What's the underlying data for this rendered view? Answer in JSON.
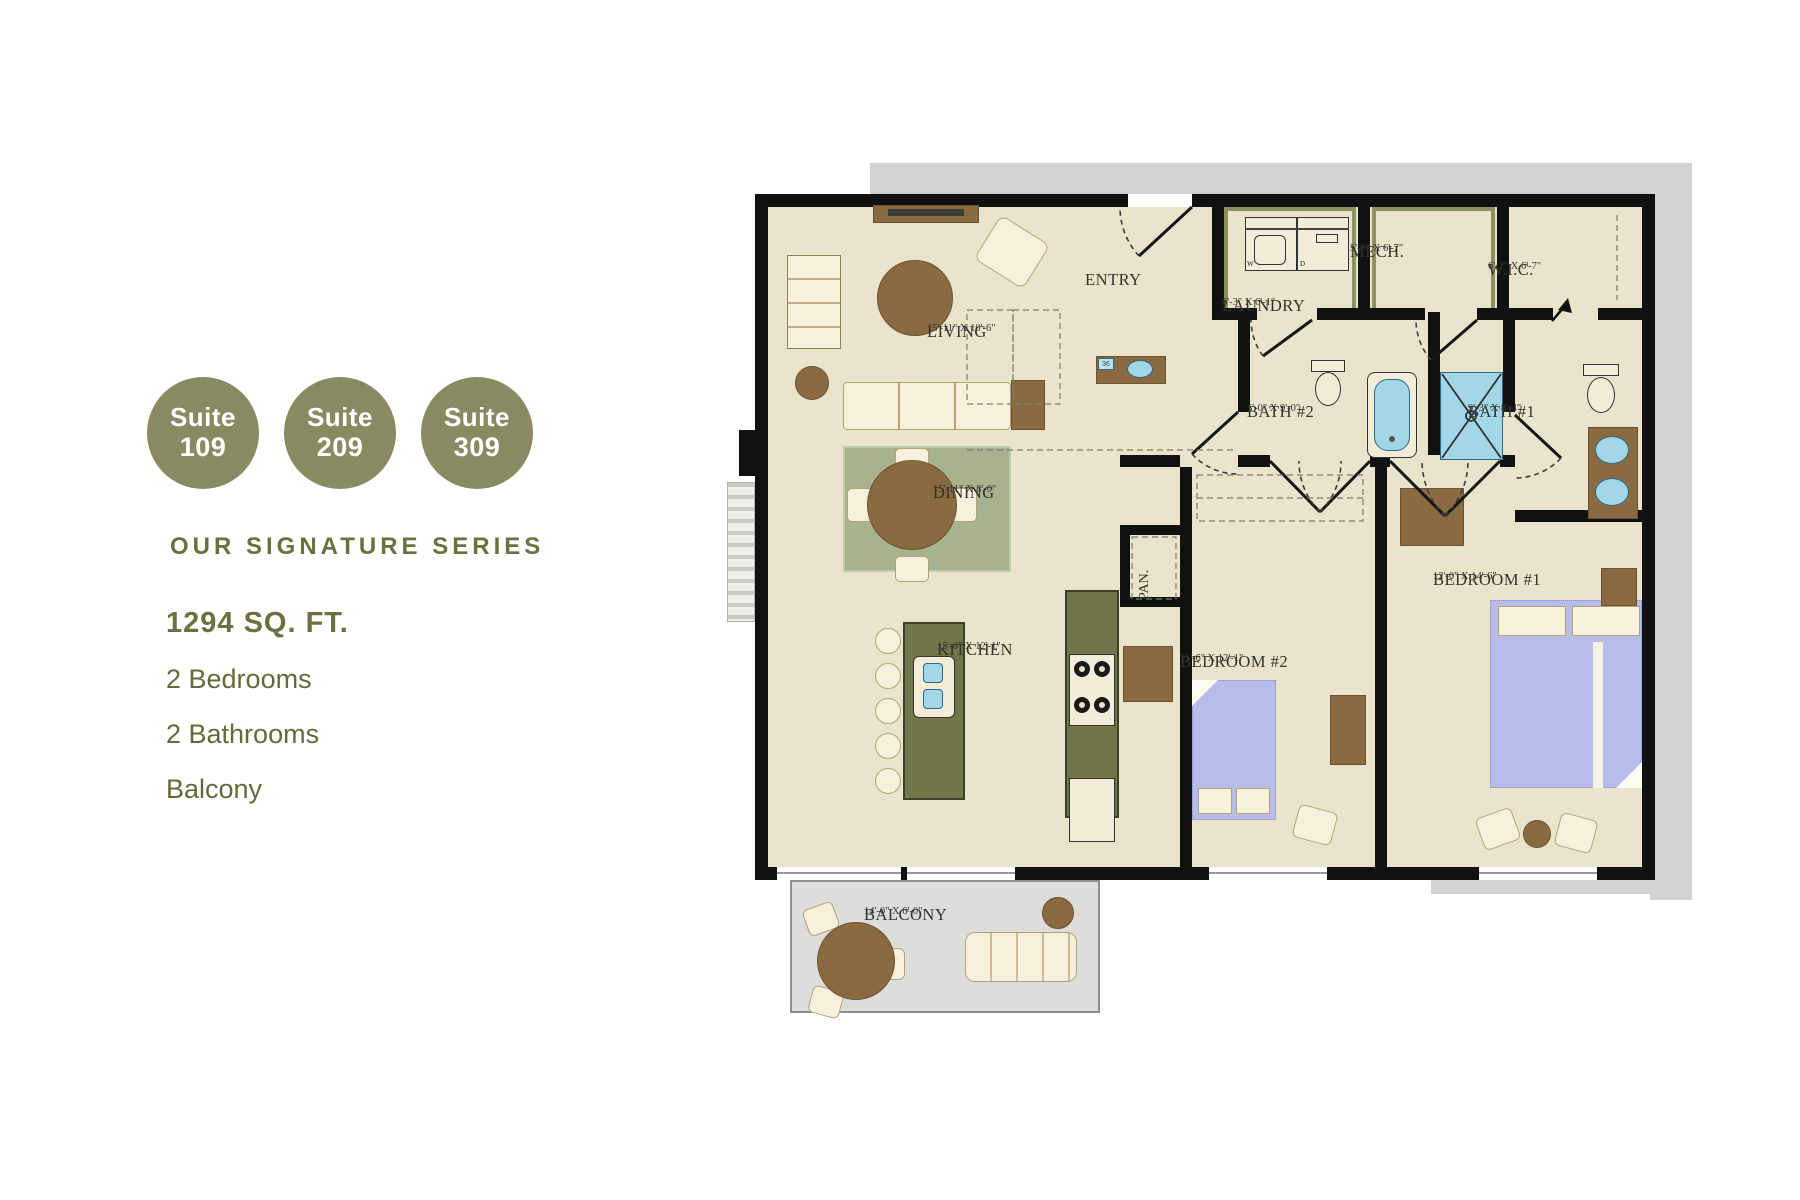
{
  "badges": [
    {
      "word": "Suite",
      "number": "109"
    },
    {
      "word": "Suite",
      "number": "209"
    },
    {
      "word": "Suite",
      "number": "309"
    }
  ],
  "info": {
    "series": "OUR SIGNATURE SERIES",
    "area": "1294 SQ. FT.",
    "features": [
      "2 Bedrooms",
      "2 Bathrooms",
      "Balcony"
    ]
  },
  "rooms": {
    "entry": {
      "label": "ENTRY",
      "dims": ""
    },
    "laundry": {
      "label": "LAUNDRY",
      "dims": "6'-3\" X 6'-1\""
    },
    "mech": {
      "label": "MECH.",
      "dims": "5'-9\" X 6'-7\""
    },
    "wic": {
      "label": "W.I.C.",
      "dims": "6'-2\" X 6'-7\""
    },
    "bath2": {
      "label": "BATH #2",
      "dims": "5'-0\" X 9'-0\""
    },
    "bath1": {
      "label": "BATH #1",
      "dims": "9'-3\" X 8'-4\""
    },
    "living": {
      "label": "LIVING",
      "dims": "15'-11\" X 10'-6\""
    },
    "dining": {
      "label": "DINING",
      "dims": "15'-11\" X 8'-0\""
    },
    "kitchen": {
      "label": "KITCHEN",
      "dims": "15'-8\" X 12'-1\""
    },
    "pantry": {
      "label": "PAN.",
      "dims": ""
    },
    "bedroom2": {
      "label": "BEDROOM #2",
      "dims": "11'-6\" X 12'-1\""
    },
    "bedroom1": {
      "label": "BEDROOM #1",
      "dims": "12'-0\" X 14'-6\""
    },
    "balcony": {
      "label": "BALCONY",
      "dims": "14'-0\" X 6'-0\""
    }
  },
  "tags": {
    "fixture": "36",
    "washer": "W",
    "dryer": "D"
  },
  "colors": {
    "accent": "#8a8a62",
    "text-olive": "#6e6f3f",
    "floor": "#eae4cd",
    "wall": "#111111",
    "exterior": "#d3d2d0",
    "balcony-floor": "#dedddb",
    "bed": "#b7bde8",
    "fixture-blue": "#a3d6e6",
    "brown": "#8a6b41",
    "brown-dark": "#6b5330",
    "rug": "#a9b28f",
    "counter": "#74744a",
    "cream": "#f7f0dd"
  }
}
